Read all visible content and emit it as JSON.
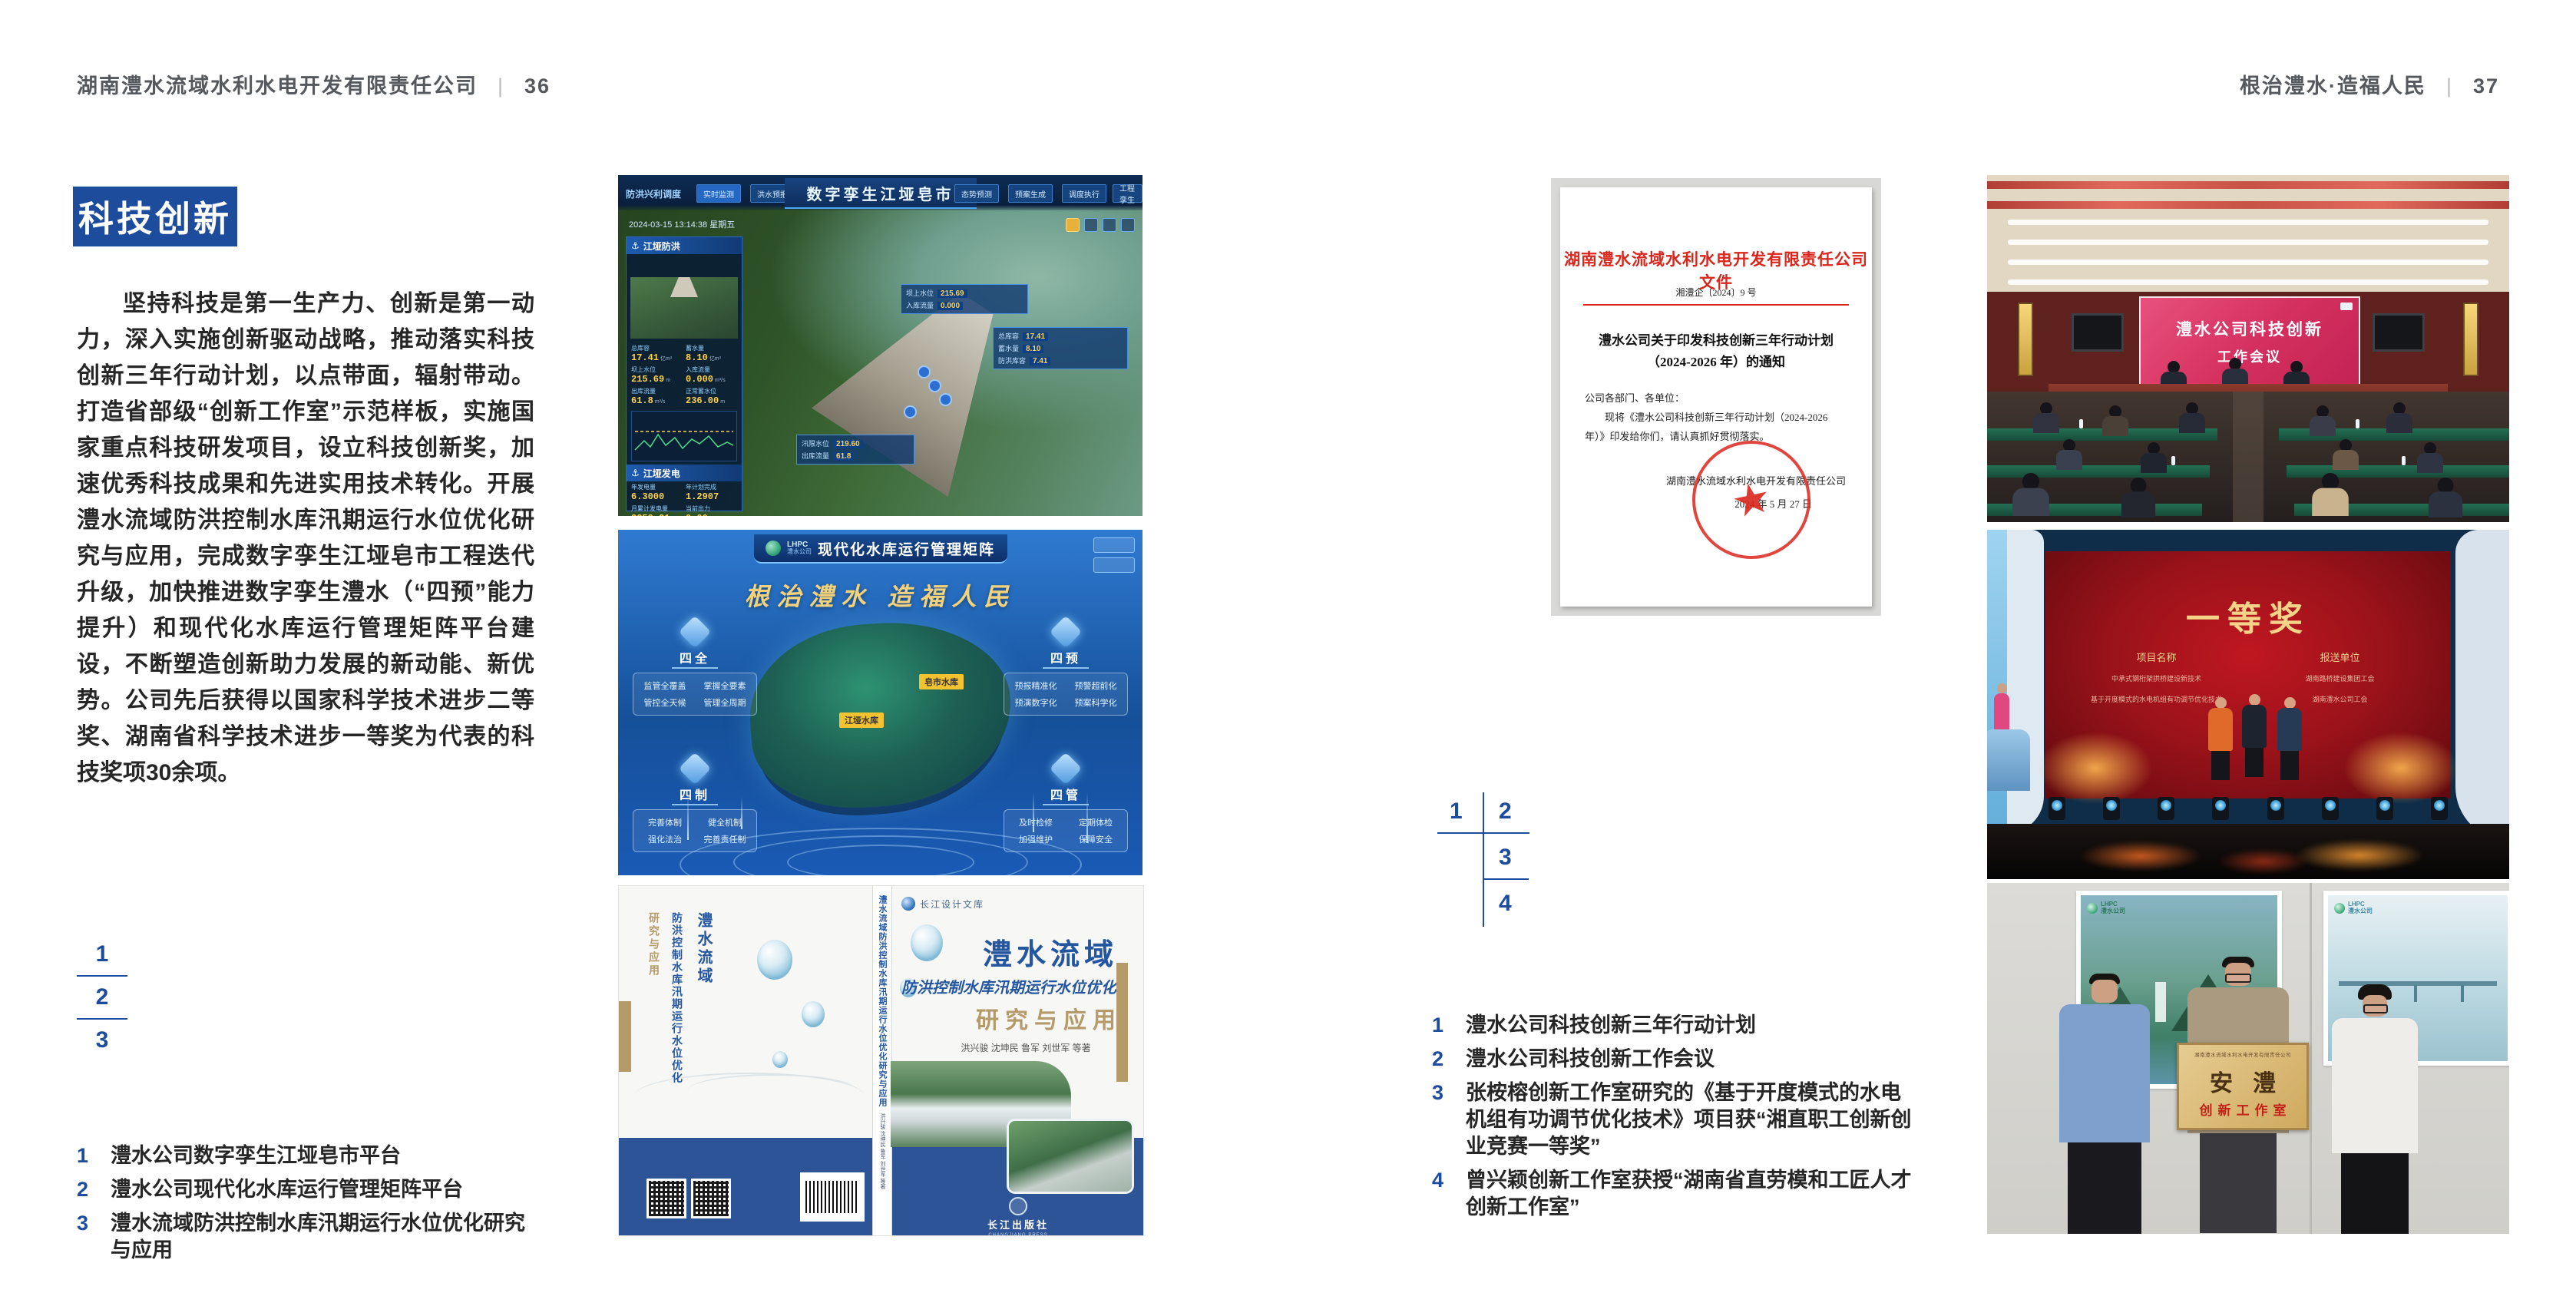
{
  "left_page": {
    "header": {
      "title": "湖南澧水流域水利水电开发有限责任公司",
      "divider": "|",
      "page": "36"
    },
    "badge": "科技创新",
    "paragraph": "坚持科技是第一生产力、创新是第一动力，深入实施创新驱动战略，推动落实科技创新三年行动计划，以点带面，辐射带动。打造省部级“创新工作室”示范样板，实施国家重点科技研发项目，设立科技创新奖，加速优秀科技成果和先进实用技术转化。开展澧水流域防洪控制水库汛期运行水位优化研究与应用，完成数字孪生江垭皂市工程迭代升级，加快推进数字孪生澧水（“四预”能力提升）和现代化水库运行管理矩阵平台建设，不断塑造创新助力发展的新动能、新优势。公司先后获得以国家科学技术进步二等奖、湖南省科学技术进步一等奖为代表的科技奖项30余项。",
    "index": [
      "1",
      "2",
      "3"
    ],
    "captions": [
      {
        "num": "1",
        "text": "澧水公司数字孪生江垭皂市平台"
      },
      {
        "num": "2",
        "text": "澧水公司现代化水库运行管理矩阵平台"
      },
      {
        "num": "3",
        "text": "澧水流域防洪控制水库汛期运行水位优化研究与应用"
      }
    ]
  },
  "right_page": {
    "header": {
      "title": "根治澧水·造福人民",
      "divider": "|",
      "page": "37"
    },
    "index": [
      "1",
      "2",
      "3",
      "4"
    ],
    "captions": [
      {
        "num": "1",
        "text": "澧水公司科技创新三年行动计划"
      },
      {
        "num": "2",
        "text": "澧水公司科技创新工作会议"
      },
      {
        "num": "3",
        "text": "张桉榕创新工作室研究的《基于开度模式的水电机组有功调节优化技术》项目获“湘直职工创新创业竞赛一等奖”"
      },
      {
        "num": "4",
        "text": "曾兴颖创新工作室获授“湖南省直劳模和工匠人才创新工作室”"
      }
    ]
  },
  "fig_twin": {
    "title": "数字孪生江垭皂市",
    "module": "防洪兴利调度",
    "tabs_left": [
      "实时监测",
      "洪水预报",
      "防洪预警"
    ],
    "tabs_right": [
      "态势预测",
      "预案生成",
      "调度执行",
      "工程孪生"
    ],
    "timestamp": "2024-03-15 13:14:38 星期五",
    "panel_flood": "江垭防洪",
    "panel_power": "江垭发电",
    "stats": [
      {
        "label": "总库容",
        "value": "17.41",
        "unit": "亿m³"
      },
      {
        "label": "蓄水量",
        "value": "8.10",
        "unit": "亿m³"
      },
      {
        "label": "坝上水位",
        "value": "215.69",
        "unit": "m"
      },
      {
        "label": "入库流量",
        "value": "0.000",
        "unit": "m³/s"
      },
      {
        "label": "出库流量",
        "value": "61.8",
        "unit": "m³/s"
      },
      {
        "label": "正常蓄水位",
        "value": "236.00",
        "unit": "m"
      },
      {
        "label": "汛限水位",
        "value": "219.60",
        "unit": "m"
      },
      {
        "label": "防洪库容",
        "value": "7.41",
        "unit": "亿m³"
      }
    ],
    "gen_stats": [
      {
        "label": "年发电量",
        "value": "6.3000"
      },
      {
        "label": "年计划完成",
        "value": "1.2907"
      },
      {
        "label": "月累计发电量",
        "value": "3259.21"
      },
      {
        "label": "当前出力",
        "value": "0.00"
      }
    ]
  },
  "fig_matrix": {
    "logo": "LHPC",
    "logo_sub": "澧水公司",
    "title": "现代化水库运行管理矩阵",
    "slogan": "根治澧水 造福人民",
    "groups": [
      {
        "title": "四全",
        "items": [
          "监管全覆盖",
          "掌握全要素",
          "管控全天候",
          "管理全周期"
        ]
      },
      {
        "title": "四预",
        "items": [
          "预报精准化",
          "预警超前化",
          "预演数字化",
          "预案科学化"
        ]
      },
      {
        "title": "四制",
        "items": [
          "完善体制",
          "健全机制",
          "强化法治",
          "完善责任制"
        ]
      },
      {
        "title": "四管",
        "items": [
          "及时检修",
          "定期体检",
          "加强维护",
          "保障安全"
        ]
      }
    ],
    "map_labels": [
      "江垭水库",
      "皂市水库"
    ]
  },
  "fig_book": {
    "series": "长江设计文库",
    "title": "澧水流域",
    "subtitle": "防洪控制水库汛期运行水位优化",
    "title2": "研究与应用",
    "authors": "洪兴骏 沈坤民 鲁军 刘世军 等著",
    "spine_title": "澧水流域防洪控制水库汛期运行水位优化研究与应用",
    "publisher": "长江出版社",
    "publisher_en": "CHANGJIANG PRESS"
  },
  "fig_doc": {
    "header": "湖南澧水流域水利水电开发有限责任公司文件",
    "doc_no": "湘澧企〔2024〕9 号",
    "title_line1": "澧水公司关于印发科技创新三年行动计划",
    "title_line2": "（2024-2026 年）的通知",
    "salutation": "公司各部门、各单位：",
    "body": "现将《澧水公司科技创新三年行动计划（2024-2026 年）》印发给你们，请认真抓好贯彻落实。",
    "signature": "湖南澧水流域水利水电开发有限责任公司",
    "date": "2024 年 5 月 27 日"
  },
  "ph_meeting": {
    "screen_line1": "澧水公司科技创新",
    "screen_line2": "工作会议"
  },
  "ph_award": {
    "title": "一等奖",
    "col1": "项目名称",
    "col2": "报送单位",
    "rows": [
      {
        "project": "中承式钢桁架拱桥建设新技术",
        "unit": "湖南路桥建设集团工会"
      },
      {
        "project": "基于开度模式的水电机组有功调节优化技术",
        "unit": "湖南澧水公司工会"
      }
    ]
  },
  "ph_plaque": {
    "org": "湖南澧水流域水利水电开发有限责任公司",
    "title": "安澧",
    "subtitle": "创新工作室",
    "logo": "LHPC",
    "logo_sub": "澧水公司"
  }
}
